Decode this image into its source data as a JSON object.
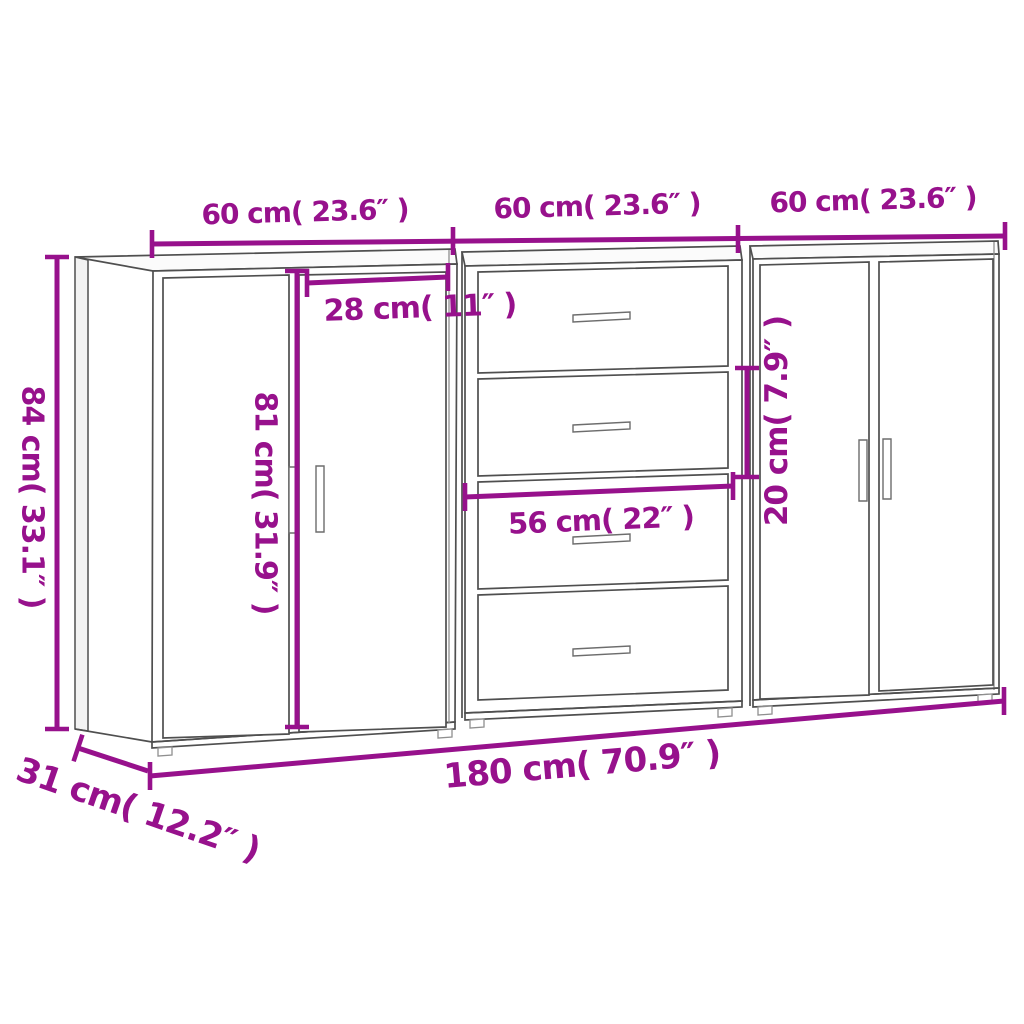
{
  "diagram": {
    "kind": "furniture-dimension-diagram",
    "cabinets": [
      {
        "name": "left-two-door-sideboard"
      },
      {
        "name": "middle-four-drawer-sideboard"
      },
      {
        "name": "right-two-door-sideboard"
      }
    ],
    "dimensions": {
      "top_width_1": {
        "label": "60 cm( 23.6″ )"
      },
      "top_width_2": {
        "label": "60 cm( 23.6″ )"
      },
      "top_width_3": {
        "label": "60 cm( 23.6″ )"
      },
      "total_height": {
        "label": "84 cm( 33.1″ )"
      },
      "door_width": {
        "label": "28 cm( 11″ )"
      },
      "door_height": {
        "label": "81 cm( 31.9″ )"
      },
      "drawer_width": {
        "label": "56 cm( 22″ )"
      },
      "drawer_height": {
        "label": "20 cm( 7.9″ )"
      },
      "total_width": {
        "label": "180 cm( 70.9″ )"
      },
      "depth": {
        "label": "31 cm( 12.2″ )"
      }
    },
    "colors": {
      "dimension_accent": "#97118C",
      "cabinet_outline": "#4f4f4f",
      "background": "#ffffff"
    }
  }
}
